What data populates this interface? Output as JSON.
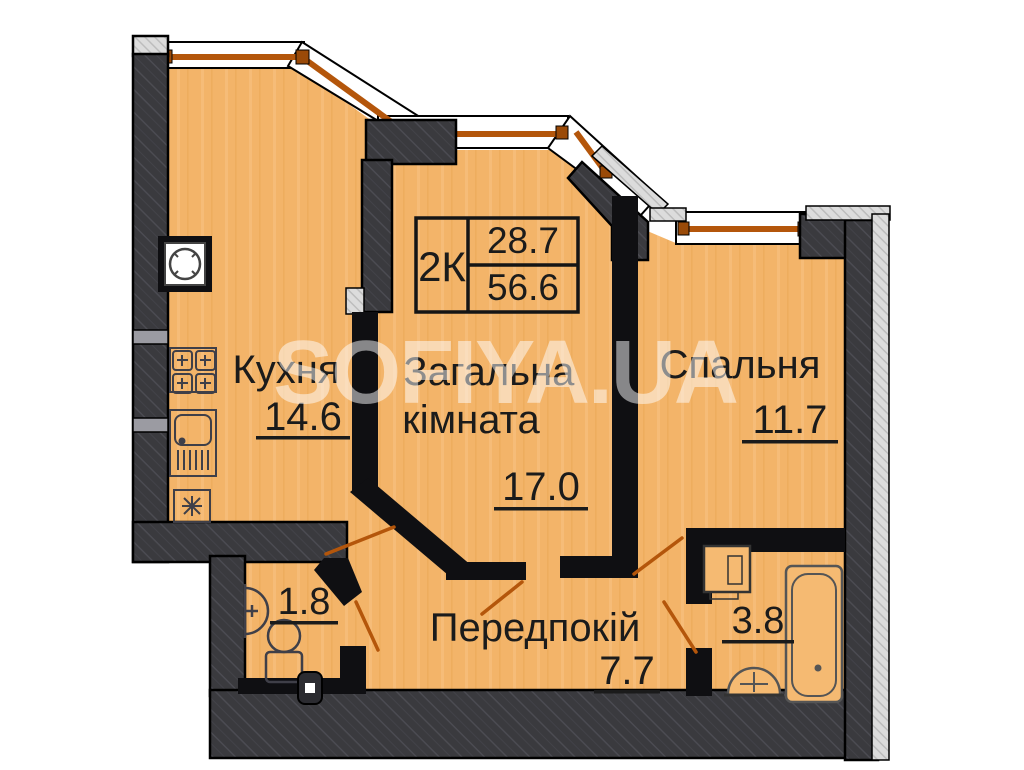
{
  "plan": {
    "watermark": "SOFIYA.UA",
    "info_box": {
      "type_label": "2К",
      "area_top": "28.7",
      "area_bottom": "56.6"
    },
    "rooms": {
      "kitchen": {
        "name": "Кухня",
        "area": "14.6"
      },
      "living": {
        "name_line1": "Загальна",
        "name_line2": "кімната",
        "area": "17.0"
      },
      "bedroom": {
        "name": "Спальня",
        "area": "11.7"
      },
      "hallway": {
        "name": "Передпокій",
        "area": "7.7"
      },
      "wc": {
        "area": "1.8"
      },
      "bathroom": {
        "area": "3.8"
      }
    },
    "fixtures": [
      "vent",
      "stove",
      "kitchen-sink",
      "fan",
      "toilet",
      "washbasin",
      "washing-machine",
      "bathtub",
      "bathroom-sink"
    ],
    "colors": {
      "floor": "#F3B469",
      "wall_dark": "#3A3A3E",
      "wall_black": "#0F0F12",
      "window_frame": "#B4560B",
      "exterior_hatch": "#DCDCDC",
      "outline": "#000000"
    }
  }
}
